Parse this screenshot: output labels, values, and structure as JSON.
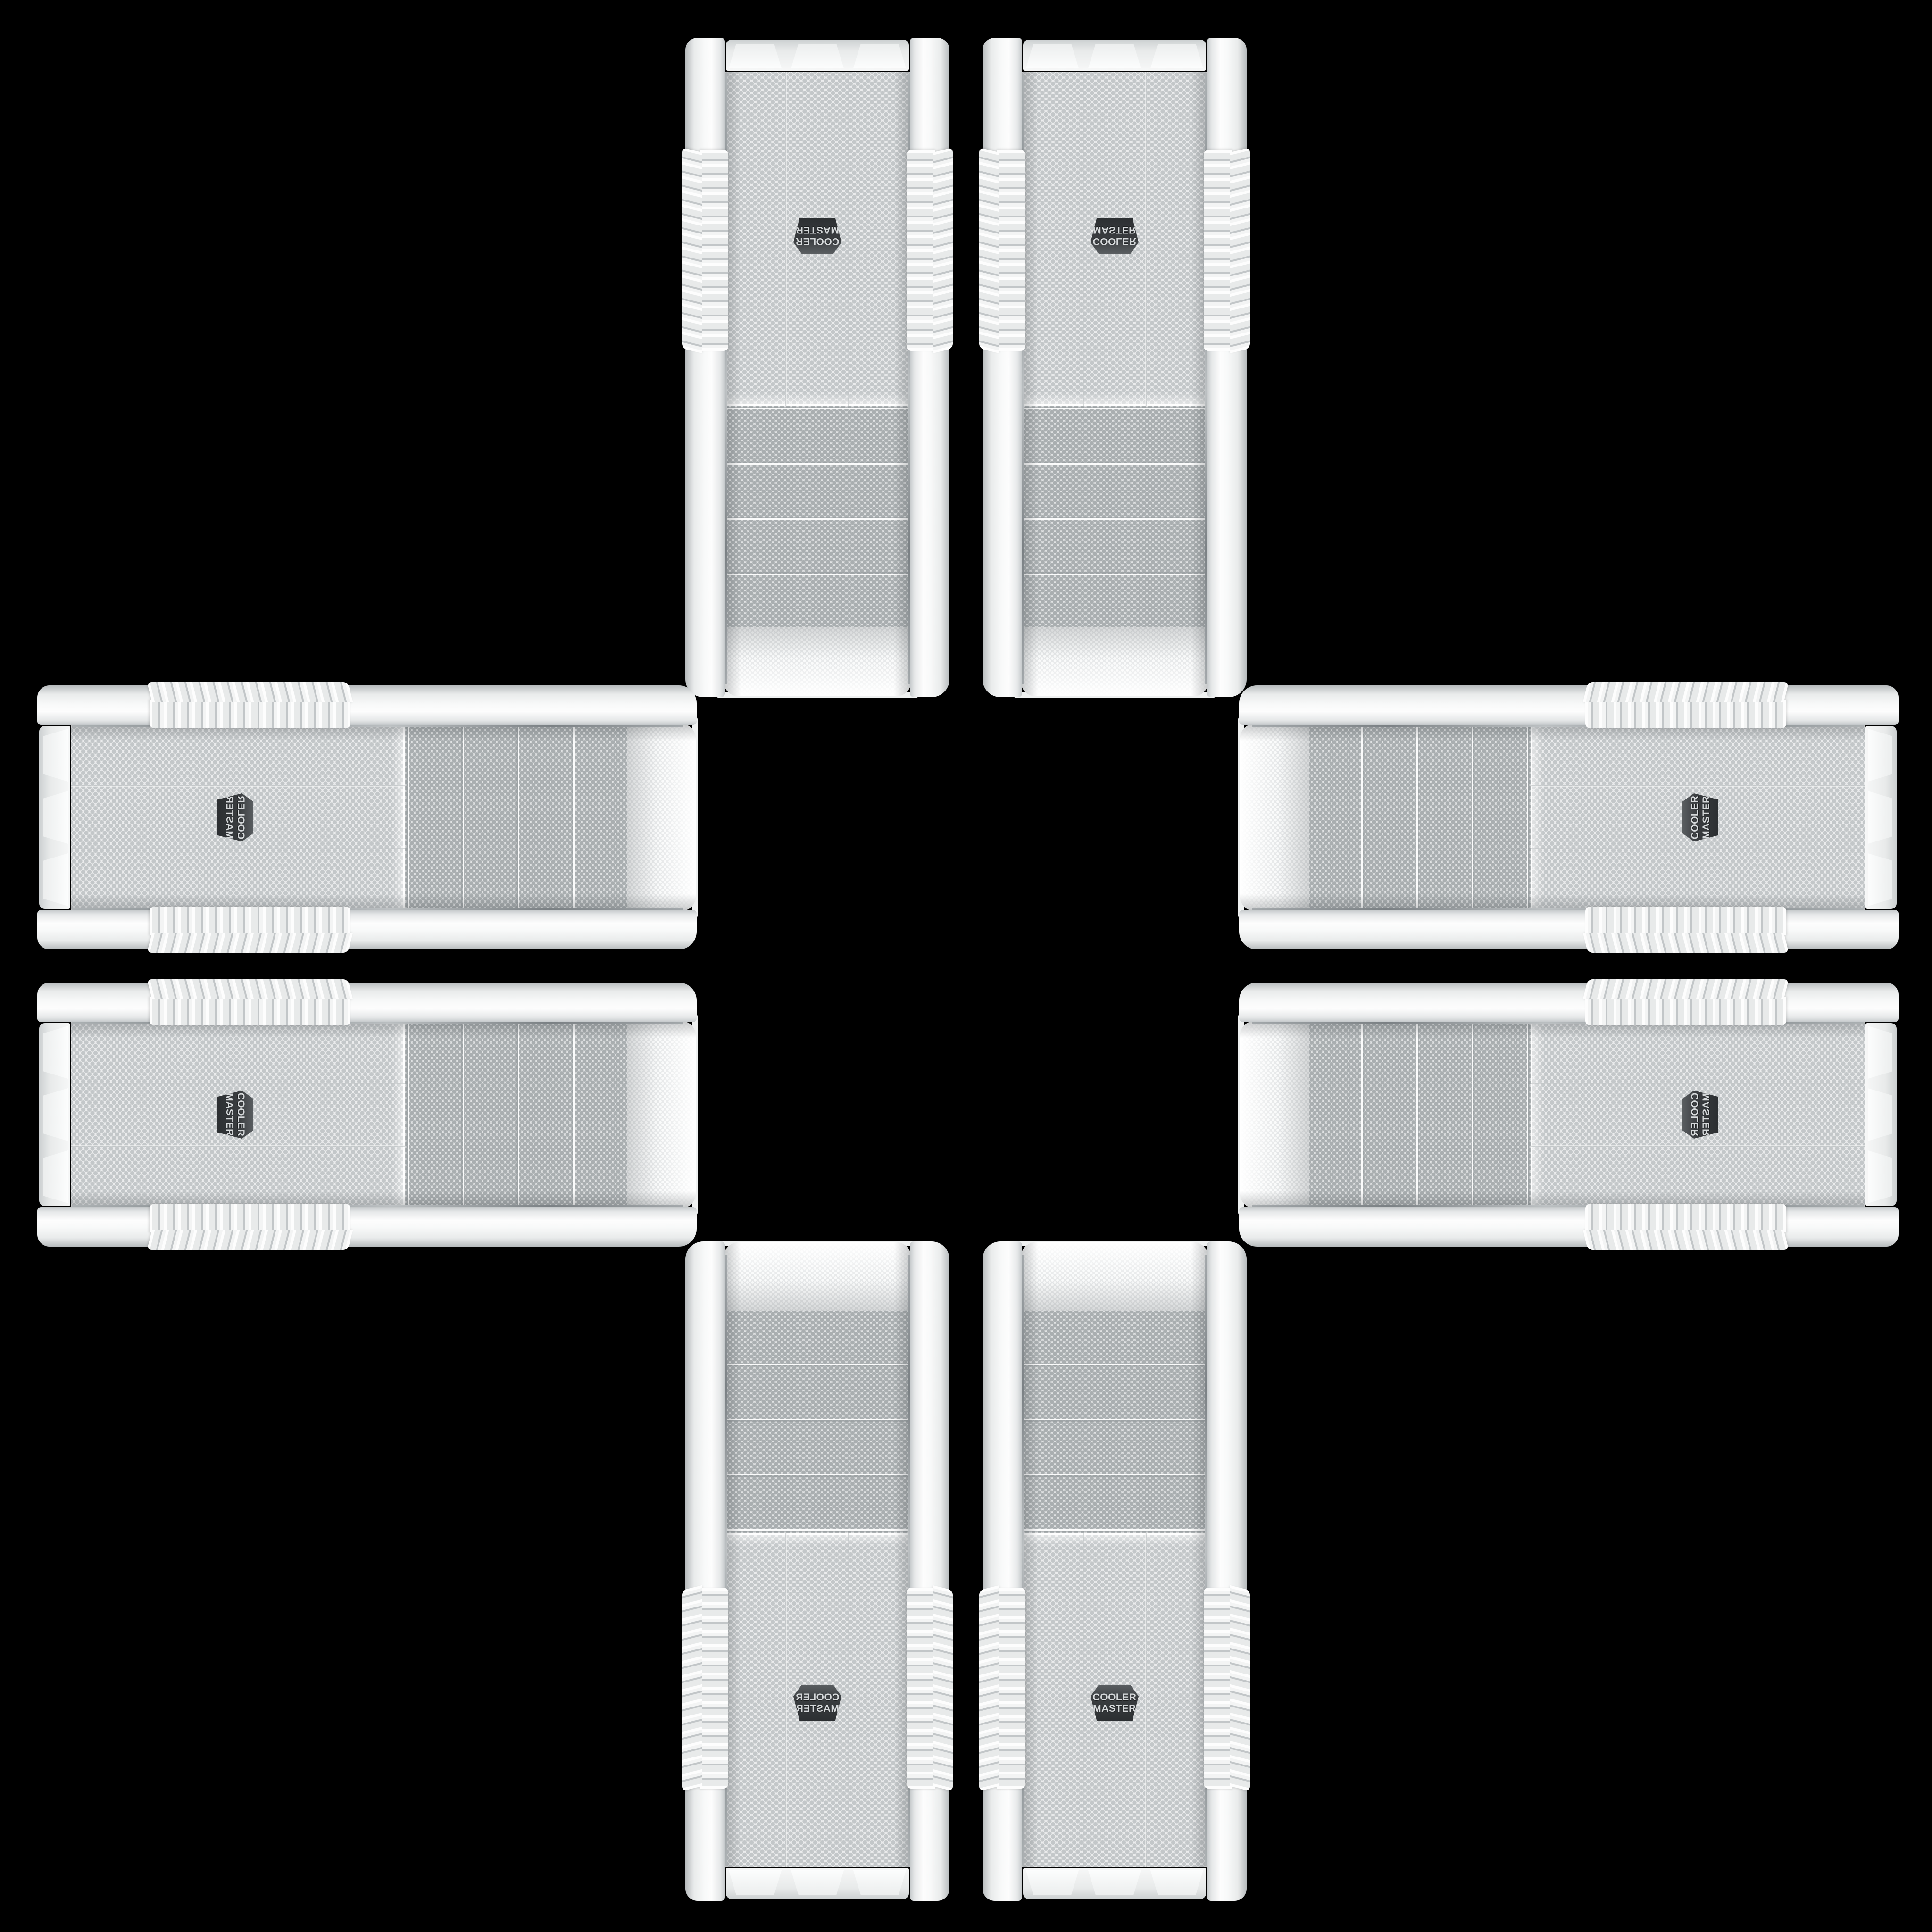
{
  "scene": {
    "background_color": "#000000",
    "description": "Eight identical white Cooler Master mesh-front PC tower cases arranged in a plus / cross pattern on a black background",
    "case_count": 8
  },
  "badge": {
    "line1": "COOLER",
    "line2": "MASTER",
    "background_color": "#3a3d40",
    "text_color": "#d6d9db"
  },
  "case_style": {
    "body_color": "#f2f3f3",
    "rail_shadow_color": "#c2c6c8",
    "bay_mesh_background": "#e0e2e3",
    "bay_mesh_dot": "#a9aeb0",
    "fan_mesh_background": "#ebeced",
    "fan_mesh_dot": "#c3c7c9",
    "top_mesh_dot": "#fafbfb",
    "chrome_trim": "#9aa0a4",
    "base_color": "#eef0f0"
  },
  "layout": {
    "pattern": "plus-cross",
    "center_empty": true,
    "arms": [
      {
        "position": "top",
        "rotation_deg": 180,
        "pair": [
          "rotated-original",
          "rotated-mirrored"
        ]
      },
      {
        "position": "left",
        "rotation_deg": 90,
        "pair": [
          "mirrored",
          "original"
        ]
      },
      {
        "position": "right",
        "rotation_deg": -90,
        "pair": [
          "original",
          "mirrored"
        ]
      },
      {
        "position": "bottom",
        "rotation_deg": 0,
        "pair": [
          "mirrored",
          "original"
        ]
      }
    ]
  }
}
